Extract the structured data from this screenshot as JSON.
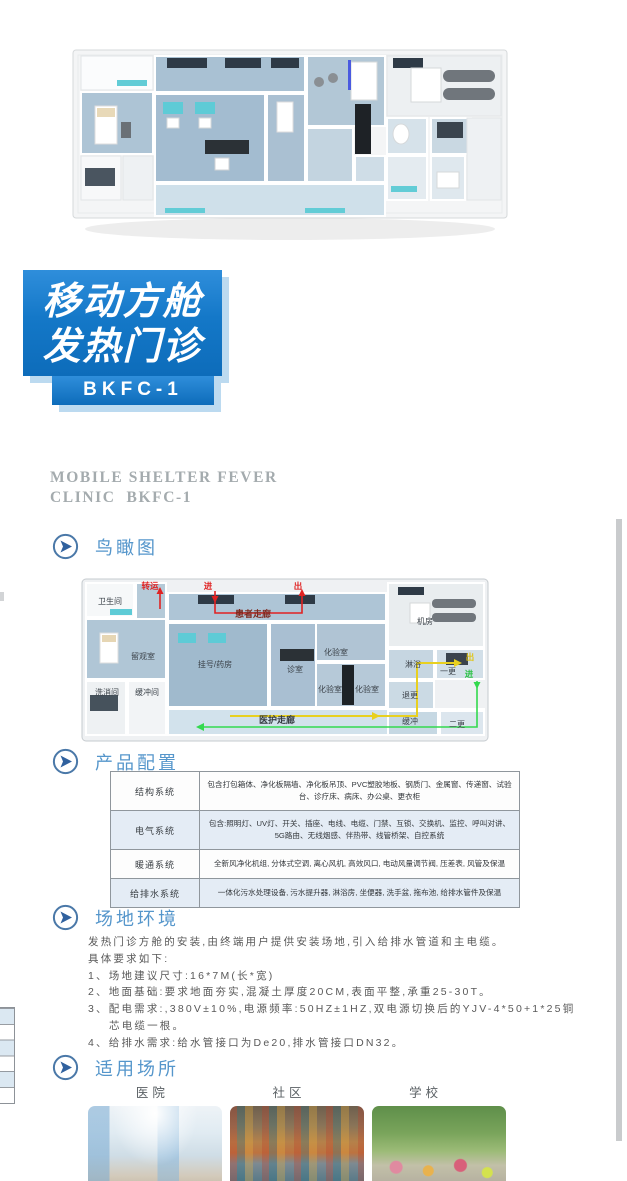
{
  "colors": {
    "accent_blue": "#5596cb",
    "icon_blue": "#3f6da3",
    "logo_blue_top": "#2f8edb",
    "logo_blue_bottom": "#0d6cba",
    "logo_shadow": "#bcdaf0",
    "heading_gray": "#a4abae",
    "flow_red": "#e02222",
    "flow_yellow": "#e8d020",
    "flow_green": "#33d94e"
  },
  "logo": {
    "line1": "移动方舱",
    "line2": "发热门诊",
    "model": "BKFC-1"
  },
  "heading_en": {
    "line1": "MOBILE SHELTER FEVER",
    "line2": "CLINIC  BKFC-1"
  },
  "sections": {
    "birdseye": {
      "title": "鸟瞰图"
    },
    "config": {
      "title": "产品配置",
      "table": {
        "rows": [
          {
            "label": "结构系统",
            "content": "包含打包箱体、净化板隔墙、净化板吊顶、PVC塑胶地板、钢质门、金属窗、传递窗、试验台、诊疗床、病床、办公桌、更衣柜"
          },
          {
            "label": "电气系统",
            "content": "包含:照明灯、UV灯、开关、插座、电线、电缆、门禁、互锁、交换机、监控、呼叫对讲、5G路由、无线烟感、伴热带、线管桥架、自控系统"
          },
          {
            "label": "暖通系统",
            "content": "全新风净化机组, 分体式空调, 离心风机, 高效风口, 电动风量调节阀, 压差表, 风管及保温"
          },
          {
            "label": "给排水系统",
            "content": "一体化污水处理设备, 污水提升器, 淋浴房, 坐便器, 洗手盆, 拖布池, 给排水管件及保温"
          }
        ]
      }
    },
    "site": {
      "title": "场地环境",
      "intro": "发热门诊方舱的安装,由终端用户提供安装场地,引入给排水管道和主电缆。",
      "requirements_heading": "具体要求如下:",
      "items": [
        "1、场地建议尺寸:16*7M(长*宽)",
        "2、地面基础:要求地面夯实,混凝土厚度20CM,表面平整,承重25-30T。",
        "3、配电需求:,380V±10%,电源频率:50HZ±1HZ,双电源切换后的YJV-4*50+1*25铜芯电缆一根。",
        "4、给排水需求:给水管接口为De20,排水管接口DN32。"
      ]
    },
    "places": {
      "title": "适用场所",
      "cards": [
        {
          "label": "医院"
        },
        {
          "label": "社区"
        },
        {
          "label": "学校"
        }
      ]
    }
  },
  "floorplan": {
    "rooms": {
      "toilet": "卫生间",
      "observation": "留观室",
      "washing": "洗消间",
      "buffer_room": "缓冲间",
      "registration": "挂号/药房",
      "consult": "诊室",
      "lab_top": "化验室",
      "lab_bottom_left": "化验室",
      "lab_bottom_right": "化验室",
      "machine_room": "机房",
      "shower": "淋浴",
      "change_first": "一更",
      "retreat_change": "退更",
      "buffer": "缓冲",
      "change_second": "二更"
    },
    "corridors": {
      "patient": "患者走廊",
      "staff": "医护走廊"
    },
    "flows": {
      "transfer": "转运",
      "patient_in": "进",
      "patient_out": "出",
      "staff_out": "出",
      "staff_in": "进"
    }
  }
}
